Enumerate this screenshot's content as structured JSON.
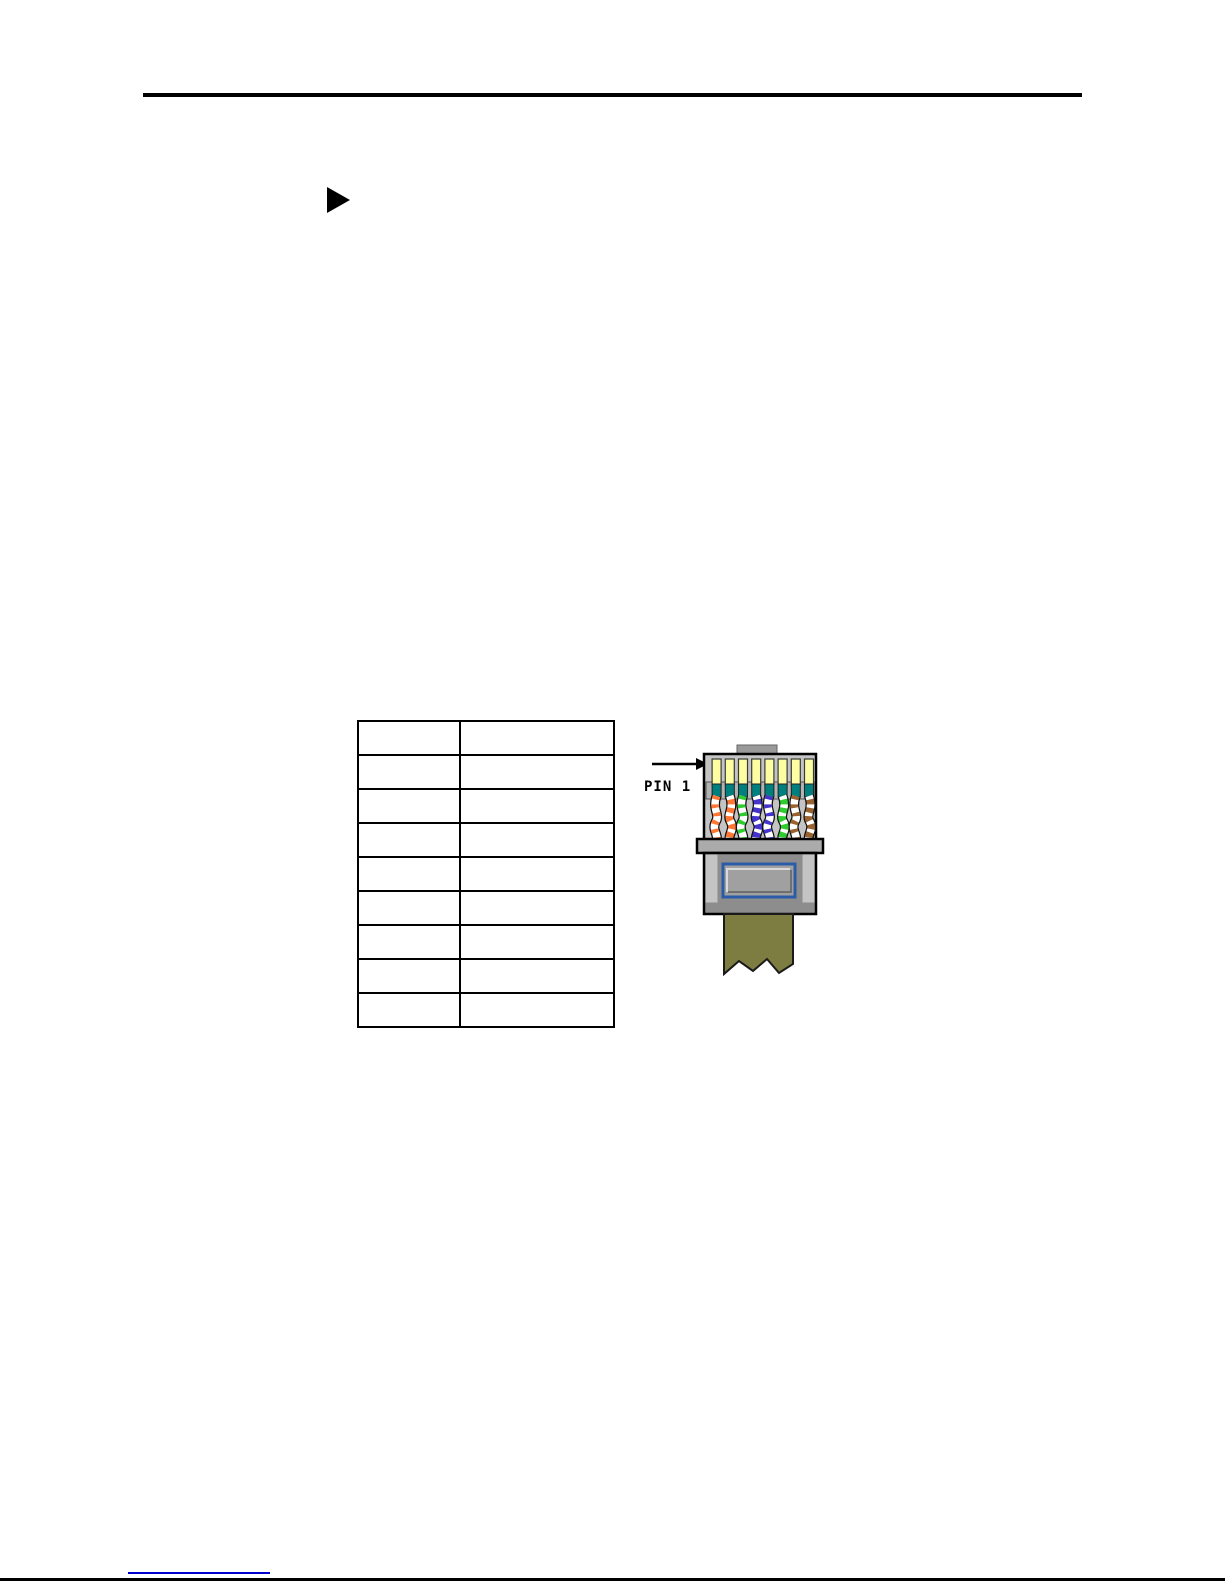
{
  "page": {
    "type": "manual-page",
    "background": "#ffffff"
  },
  "header": {
    "rule_color": "#000000"
  },
  "bullet": {
    "shape": "right-pointing-triangle",
    "color": "#000000"
  },
  "pin_table": {
    "columns": 2,
    "rows": [
      [
        "",
        ""
      ],
      [
        "",
        ""
      ],
      [
        "",
        ""
      ],
      [
        "",
        ""
      ],
      [
        "",
        ""
      ],
      [
        "",
        ""
      ],
      [
        "",
        ""
      ],
      [
        "",
        ""
      ],
      [
        "",
        ""
      ]
    ]
  },
  "connector": {
    "pin_label": "PIN 1",
    "body_color": "#c4c4c4",
    "tab_color": "#9a9a9a",
    "flange_color": "#ababab",
    "lower_body_color": "#8d8d8d",
    "pin_color": "#fdfda1",
    "contact_color": "#007f7f",
    "contact_bar_color": "#b2b2b2",
    "latch_outline_color": "#2b5ca8",
    "latch_fill_color": "#a0a0a0",
    "cable_color": "#7d7d42",
    "wires": [
      {
        "name": "white-orange",
        "base": "#ffffff",
        "stripe": "#ff7733"
      },
      {
        "name": "orange",
        "base": "#ff7733",
        "stripe": "#ffffff"
      },
      {
        "name": "white-green",
        "base": "#ffffff",
        "stripe": "#2ecc2e"
      },
      {
        "name": "blue",
        "base": "#4433cc",
        "stripe": "#ffffff"
      },
      {
        "name": "white-blue",
        "base": "#ffffff",
        "stripe": "#4433cc"
      },
      {
        "name": "green",
        "base": "#2ecc2e",
        "stripe": "#ffffff"
      },
      {
        "name": "white-brown",
        "base": "#ffffff",
        "stripe": "#99622e"
      },
      {
        "name": "brown",
        "base": "#99622e",
        "stripe": "#ffffff"
      }
    ]
  },
  "footer": {
    "link_color": "#0000cc",
    "rule_color": "#000000"
  }
}
